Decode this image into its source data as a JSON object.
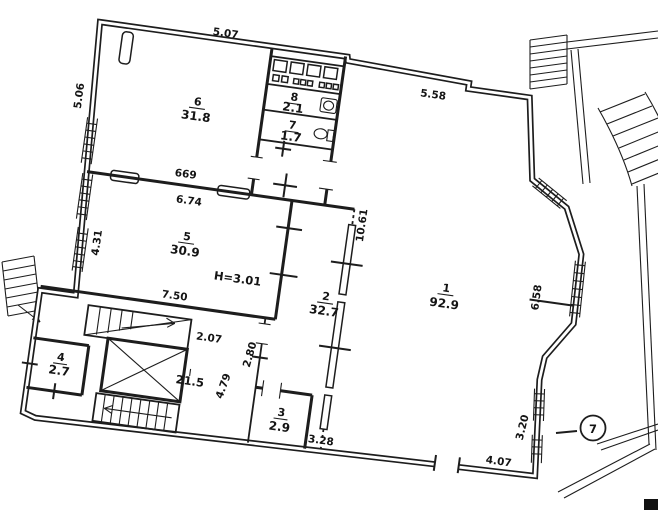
{
  "rooms": {
    "r1": {
      "num": "1",
      "area": "92.9"
    },
    "r2": {
      "num": "2",
      "area": "32.7"
    },
    "r3": {
      "num": "3",
      "area": "2.9"
    },
    "r4": {
      "num": "4",
      "area": "2.7"
    },
    "r5": {
      "num": "5",
      "area": "30.9"
    },
    "r6": {
      "num": "6",
      "area": "31.8"
    },
    "r7": {
      "num": "7",
      "area": "1.7"
    },
    "r8": {
      "num": "8",
      "area": "2.1"
    }
  },
  "dims": {
    "d507": "5.07",
    "d506": "5.06",
    "d669": "669",
    "d674": "6.74",
    "d431": "4.31",
    "d558": "5.58",
    "d1061": "10.61",
    "d658": "6.58",
    "d750": "7.50",
    "d207": "2.07",
    "d479": "4.79",
    "d280": "2.80",
    "d328": "3.28",
    "d407": "4.07",
    "d320": "3.20"
  },
  "annotations": {
    "ceiling_height": "H=3.01",
    "hall_area": "21.5",
    "axis_marker": "7"
  },
  "colors": {
    "ink": "#1d1d1d",
    "paper": "#ffffff"
  }
}
